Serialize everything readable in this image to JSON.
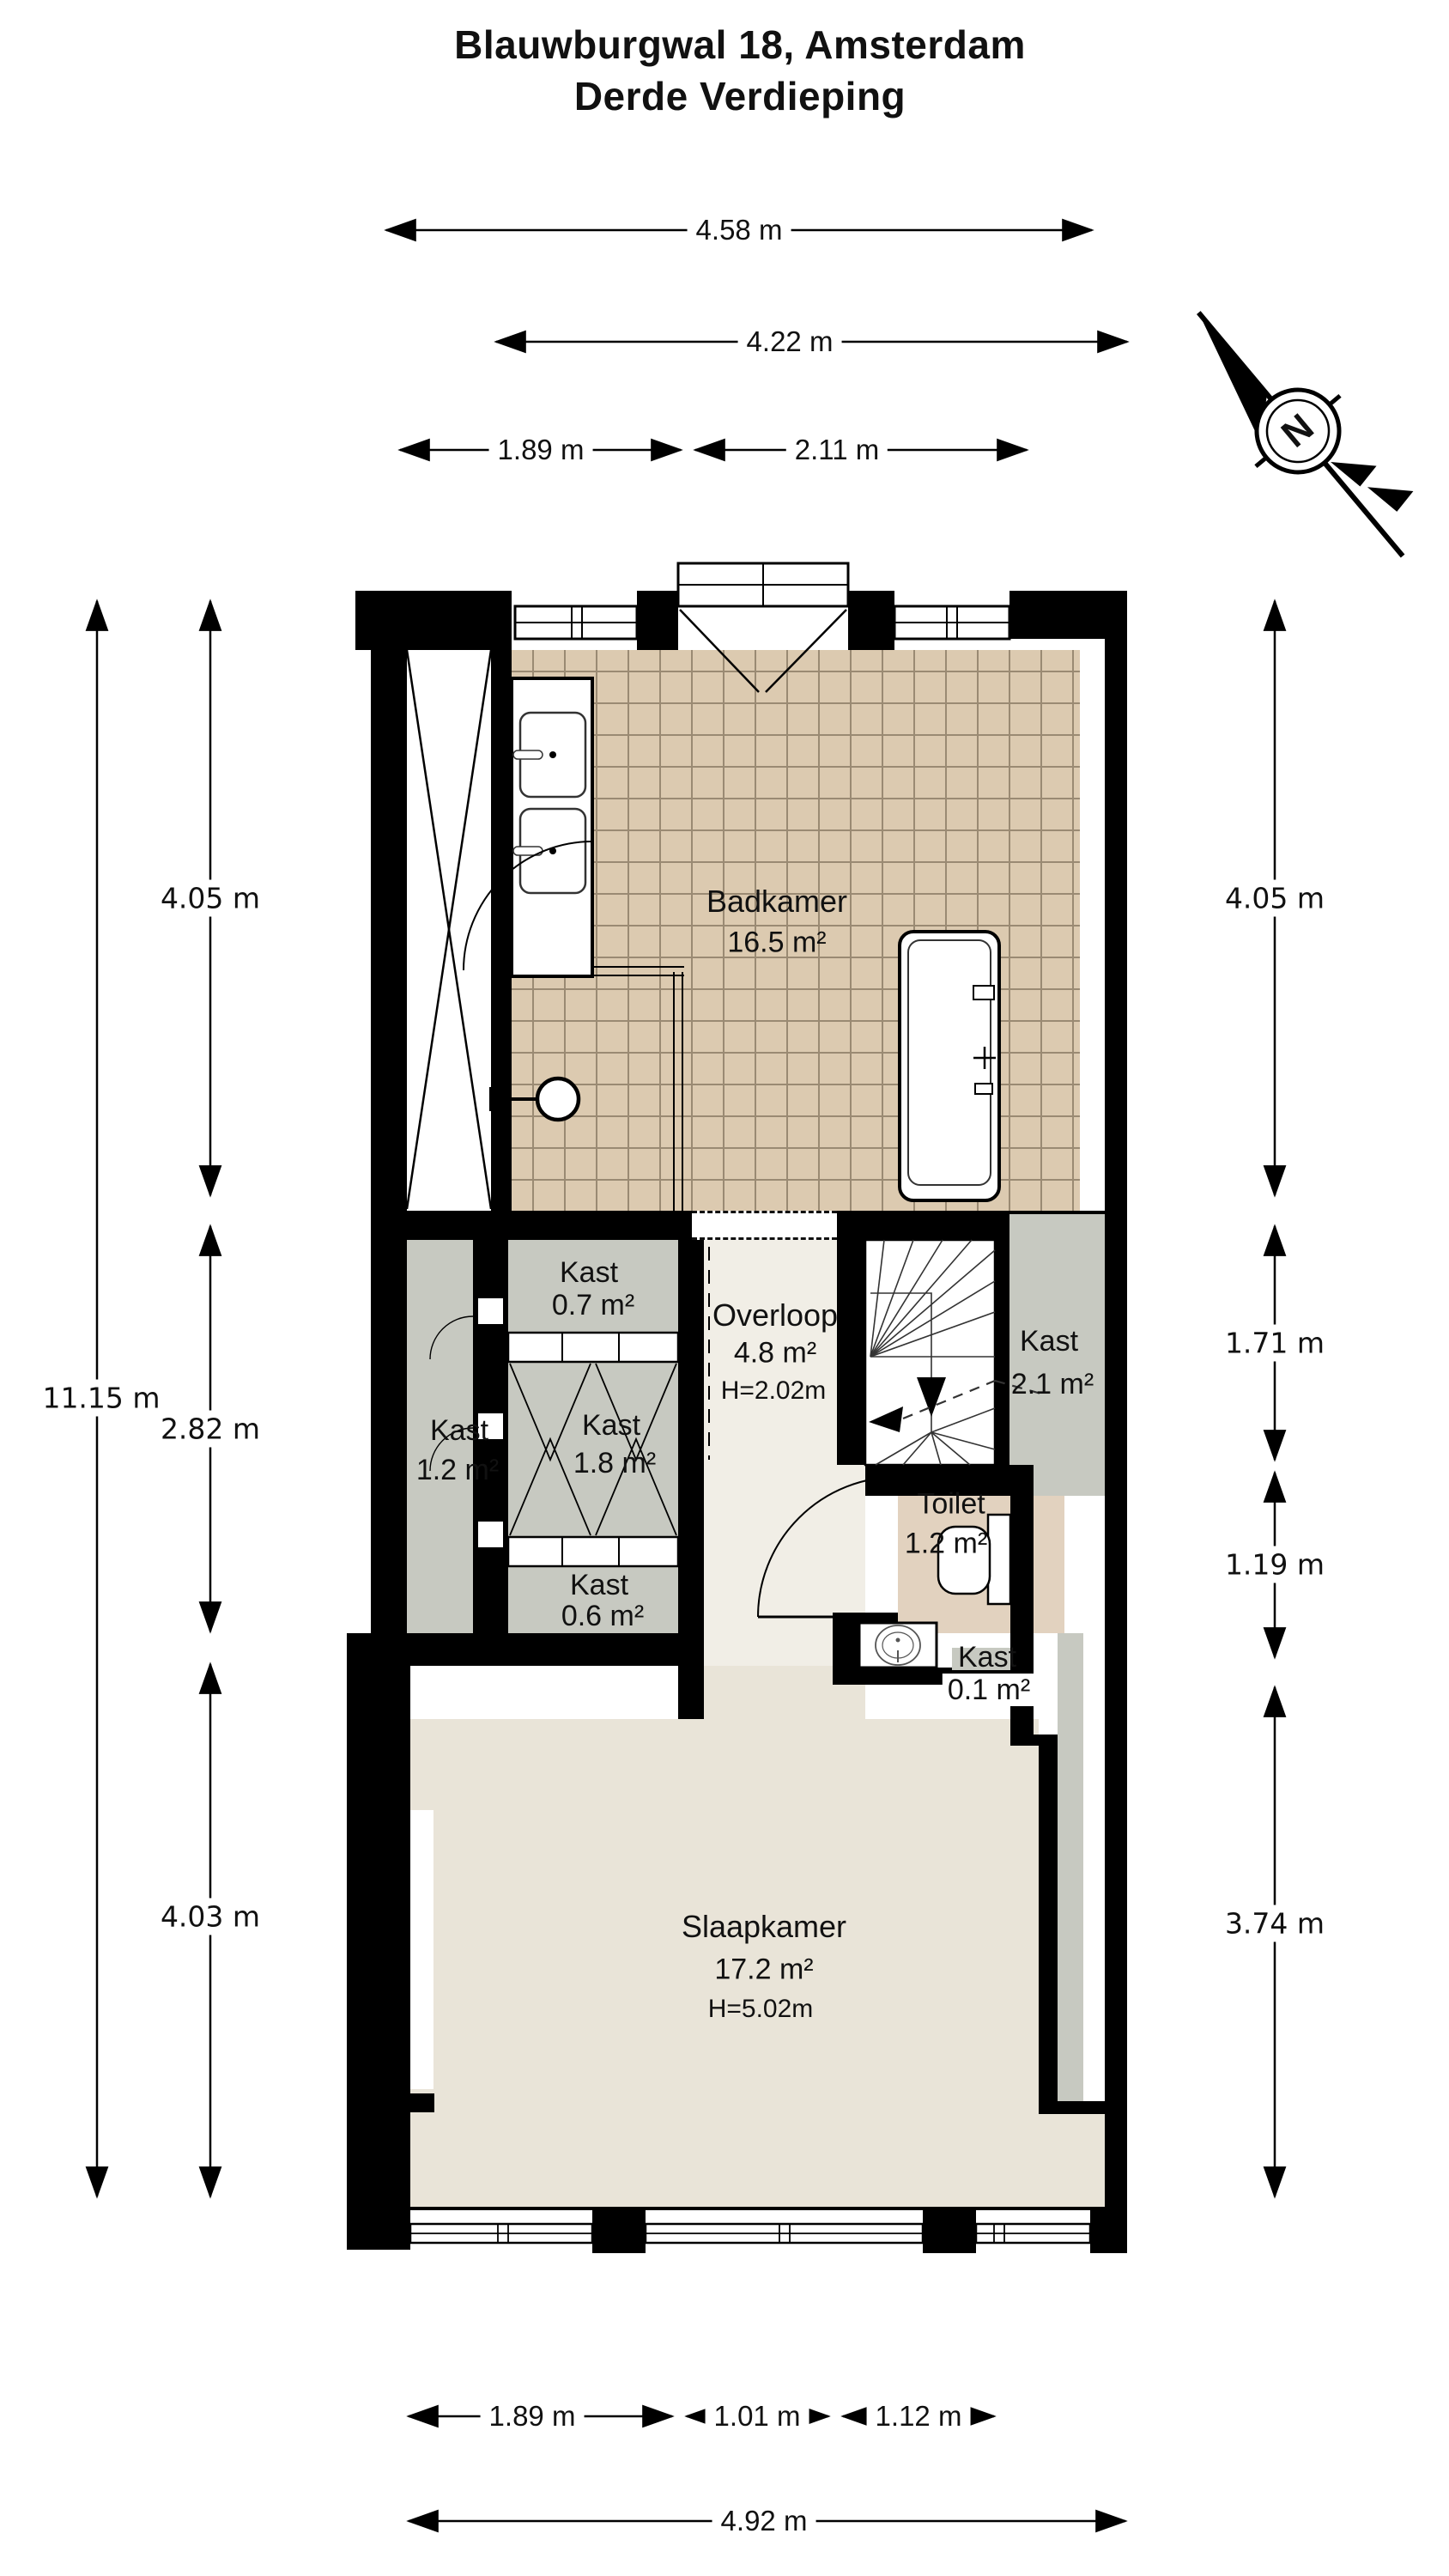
{
  "title": {
    "line1": "Blauwburgwal 18, Amsterdam",
    "line2": "Derde Verdieping"
  },
  "compass": {
    "label": "N"
  },
  "rooms": {
    "badkamer": {
      "name": "Badkamer",
      "area": "16.5 m²"
    },
    "overloop": {
      "name": "Overloop",
      "area": "4.8 m²",
      "ceiling": "H=2.02m"
    },
    "slaapkamer": {
      "name": "Slaapkamer",
      "area": "17.2 m²",
      "ceiling": "H=5.02m"
    },
    "toilet": {
      "name": "Toilet",
      "area": "1.2 m²"
    },
    "kast_top": {
      "name": "Kast",
      "area": "0.7 m²"
    },
    "kast_left": {
      "name": "Kast",
      "area": "1.2 m²"
    },
    "kast_center": {
      "name": "Kast",
      "area": "1.8 m²"
    },
    "kast_bottom": {
      "name": "Kast",
      "area": "0.6 m²"
    },
    "kast_stairs": {
      "name": "Kast",
      "area": "2.1 m²"
    },
    "kast_small": {
      "name": "Kast",
      "area": "0.1 m²"
    }
  },
  "dimensions": {
    "top": {
      "total": "4.58 m",
      "inner": "4.22 m",
      "left": "1.89 m",
      "right": "2.11 m"
    },
    "bottom": {
      "left": "1.89 m",
      "center": "1.01 m",
      "right": "1.12 m",
      "total": "4.92 m"
    },
    "left": {
      "total": "11.15 m",
      "top": "4.05 m",
      "middle": "2.82 m",
      "bottom": "4.03 m"
    },
    "right": {
      "top": "4.05 m",
      "upper_middle": "1.71 m",
      "lower_middle": "1.19 m",
      "bottom": "3.74 m"
    }
  },
  "colors": {
    "wall": "#000000",
    "tile_floor": "#dccab0",
    "tile_grout": "#9a8a73",
    "closet_floor": "#c7c9c1",
    "hall_floor": "#f1eee6",
    "bedroom_floor": "#e9e4d8",
    "toilet_floor": "#e2d2bf",
    "background": "#ffffff"
  }
}
